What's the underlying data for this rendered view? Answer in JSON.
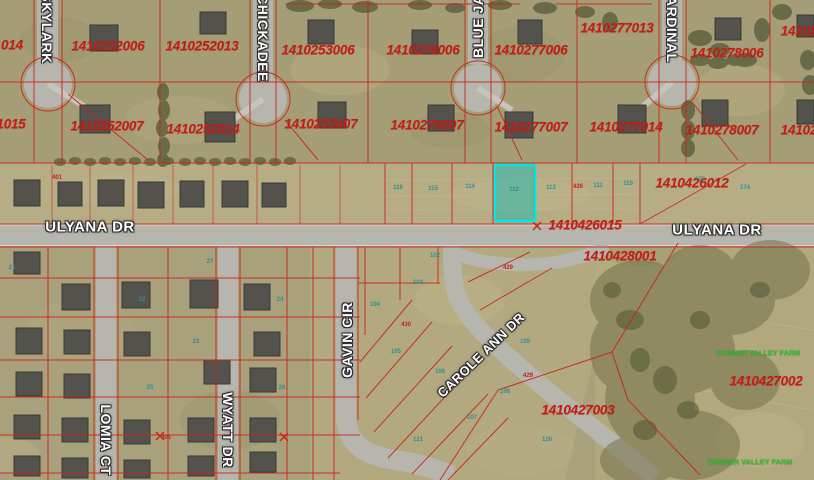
{
  "map": {
    "accent_colors": {
      "parcel_line": "#c9241a",
      "parcel_text": "#c41d15",
      "selected_parcel_stroke": "#00e6e6",
      "selected_parcel_fill": "rgba(0,185,185,0.42)",
      "street_text": "#ffffff",
      "subdivision_text": "#2ec22e",
      "lot_number_teal": "#2d9090"
    },
    "selected_parcel": {
      "x": 495,
      "y": 165,
      "w": 40,
      "h": 56
    },
    "parcel_labels": [
      {
        "text": "014",
        "x": 12,
        "y": 45
      },
      {
        "text": "1410252006",
        "x": 108,
        "y": 46
      },
      {
        "text": "1410252013",
        "x": 202,
        "y": 46
      },
      {
        "text": "1410253006",
        "x": 318,
        "y": 50
      },
      {
        "text": "1410276006",
        "x": 423,
        "y": 50
      },
      {
        "text": "1410277006",
        "x": 531,
        "y": 50
      },
      {
        "text": "1410277013",
        "x": 617,
        "y": 28
      },
      {
        "text": "1410278006",
        "x": 727,
        "y": 53
      },
      {
        "text": "14102",
        "x": 799,
        "y": 31
      },
      {
        "text": "1015",
        "x": 11,
        "y": 124
      },
      {
        "text": "1410252007",
        "x": 107,
        "y": 126
      },
      {
        "text": "1410252014",
        "x": 203,
        "y": 129
      },
      {
        "text": "1410253007",
        "x": 321,
        "y": 124
      },
      {
        "text": "1410276007",
        "x": 427,
        "y": 125
      },
      {
        "text": "1410277007",
        "x": 531,
        "y": 127
      },
      {
        "text": "1410277014",
        "x": 626,
        "y": 127
      },
      {
        "text": "1410278007",
        "x": 722,
        "y": 130
      },
      {
        "text": "14102",
        "x": 799,
        "y": 130
      },
      {
        "text": "1410426012",
        "x": 692,
        "y": 183
      },
      {
        "text": "1410426015",
        "x": 585,
        "y": 225
      },
      {
        "text": "1410428001",
        "x": 620,
        "y": 256
      },
      {
        "text": "1410427003",
        "x": 578,
        "y": 410
      },
      {
        "text": "1410427002",
        "x": 766,
        "y": 381
      }
    ],
    "street_labels": [
      {
        "text": "SKYLARK",
        "x": 47,
        "y": 28,
        "rot": 90
      },
      {
        "text": "CHICKADEE",
        "x": 263,
        "y": 38,
        "rot": 90
      },
      {
        "text": "BLUE JAY",
        "x": 478,
        "y": 22,
        "rot": -90
      },
      {
        "text": "CARDINAL",
        "x": 672,
        "y": 24,
        "rot": 90
      },
      {
        "text": "ULYANA DR",
        "x": 90,
        "y": 227,
        "rot": 0,
        "fs": 15
      },
      {
        "text": "ULYANA DR",
        "x": 717,
        "y": 230,
        "rot": 0,
        "fs": 15
      },
      {
        "text": "GAVIN CIR",
        "x": 347,
        "y": 340,
        "rot": -90
      },
      {
        "text": "CAROLE ANN DR",
        "x": 481,
        "y": 355,
        "rot": -44,
        "fs": 13
      },
      {
        "text": "WYATT DR",
        "x": 228,
        "y": 430,
        "rot": 90
      },
      {
        "text": "LOMIA CT",
        "x": 106,
        "y": 440,
        "rot": 90
      }
    ],
    "green_labels": [
      {
        "text": "CONNER VALLEY FARM",
        "x": 758,
        "y": 354
      },
      {
        "text": "CONNER VALLEY FARM",
        "x": 750,
        "y": 463
      }
    ],
    "lot_numbers": [
      {
        "text": "401",
        "x": 57,
        "y": 178,
        "c": "#c4231a"
      },
      {
        "text": "426",
        "x": 578,
        "y": 187,
        "c": "#c4231a"
      },
      {
        "text": "429",
        "x": 508,
        "y": 268,
        "c": "#c4231a"
      },
      {
        "text": "430",
        "x": 406,
        "y": 325,
        "c": "#c4231a"
      },
      {
        "text": "429",
        "x": 528,
        "y": 376,
        "c": "#c4231a"
      },
      {
        "text": "405",
        "x": 166,
        "y": 438,
        "c": "#c4231a"
      },
      {
        "text": "116",
        "x": 398,
        "y": 188,
        "c": "#2d9090"
      },
      {
        "text": "115",
        "x": 433,
        "y": 189,
        "c": "#2d9090"
      },
      {
        "text": "114",
        "x": 470,
        "y": 187,
        "c": "#2d9090"
      },
      {
        "text": "113",
        "x": 514,
        "y": 190,
        "c": "#2d9090"
      },
      {
        "text": "112",
        "x": 551,
        "y": 188,
        "c": "#2d9090"
      },
      {
        "text": "111",
        "x": 598,
        "y": 186,
        "c": "#2d9090"
      },
      {
        "text": "110",
        "x": 628,
        "y": 184,
        "c": "#2d9090"
      },
      {
        "text": "173",
        "x": 700,
        "y": 180,
        "c": "#2d9090"
      },
      {
        "text": "174",
        "x": 745,
        "y": 188,
        "c": "#2d9090"
      },
      {
        "text": "102",
        "x": 435,
        "y": 256,
        "c": "#2d9090"
      },
      {
        "text": "103",
        "x": 418,
        "y": 283,
        "c": "#2d9090"
      },
      {
        "text": "104",
        "x": 375,
        "y": 305,
        "c": "#2d9090"
      },
      {
        "text": "105",
        "x": 396,
        "y": 352,
        "c": "#2d9090"
      },
      {
        "text": "106",
        "x": 440,
        "y": 372,
        "c": "#2d9090"
      },
      {
        "text": "107",
        "x": 472,
        "y": 418,
        "c": "#2d9090"
      },
      {
        "text": "108",
        "x": 505,
        "y": 392,
        "c": "#2d9090"
      },
      {
        "text": "109",
        "x": 525,
        "y": 342,
        "c": "#2d9090"
      },
      {
        "text": "120",
        "x": 547,
        "y": 440,
        "c": "#2d9090"
      },
      {
        "text": "121",
        "x": 418,
        "y": 440,
        "c": "#2d9090"
      },
      {
        "text": "21",
        "x": 12,
        "y": 268,
        "c": "#2d9090"
      },
      {
        "text": "22",
        "x": 142,
        "y": 300,
        "c": "#2d9090"
      },
      {
        "text": "23",
        "x": 196,
        "y": 342,
        "c": "#2d9090"
      },
      {
        "text": "24",
        "x": 280,
        "y": 300,
        "c": "#2d9090"
      },
      {
        "text": "25",
        "x": 150,
        "y": 388,
        "c": "#2d9090"
      },
      {
        "text": "26",
        "x": 282,
        "y": 388,
        "c": "#2d9090"
      },
      {
        "text": "27",
        "x": 210,
        "y": 262,
        "c": "#2d9090"
      }
    ]
  }
}
